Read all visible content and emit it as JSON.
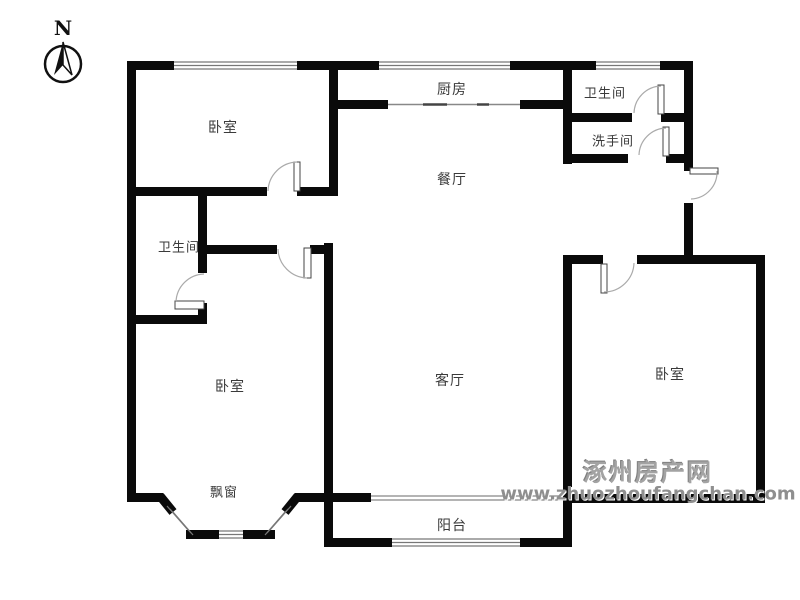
{
  "compass": {
    "label": "N"
  },
  "rooms": {
    "bedroom_nw": {
      "label": "卧室"
    },
    "kitchen": {
      "label": "厨房"
    },
    "bathroom_ne": {
      "label": "卫生间"
    },
    "washroom": {
      "label": "洗手间"
    },
    "dining": {
      "label": "餐厅"
    },
    "bathroom_w": {
      "label": "卫生间"
    },
    "bedroom_sw": {
      "label": "卧室"
    },
    "living": {
      "label": "客厅"
    },
    "bedroom_e": {
      "label": "卧室"
    },
    "bay_window": {
      "label": "飘窗"
    },
    "balcony": {
      "label": "阳台"
    }
  },
  "watermark": {
    "site_name": "涿州房产网",
    "site_url": "www.zhuozhoufangchan.com"
  },
  "colors": {
    "wall": "#0a0a0a",
    "window_line": "#777777",
    "door_arc": "#aaaaaa",
    "label_text": "#3a3a3a",
    "watermark": "#9a9a9a",
    "background": "#ffffff"
  }
}
